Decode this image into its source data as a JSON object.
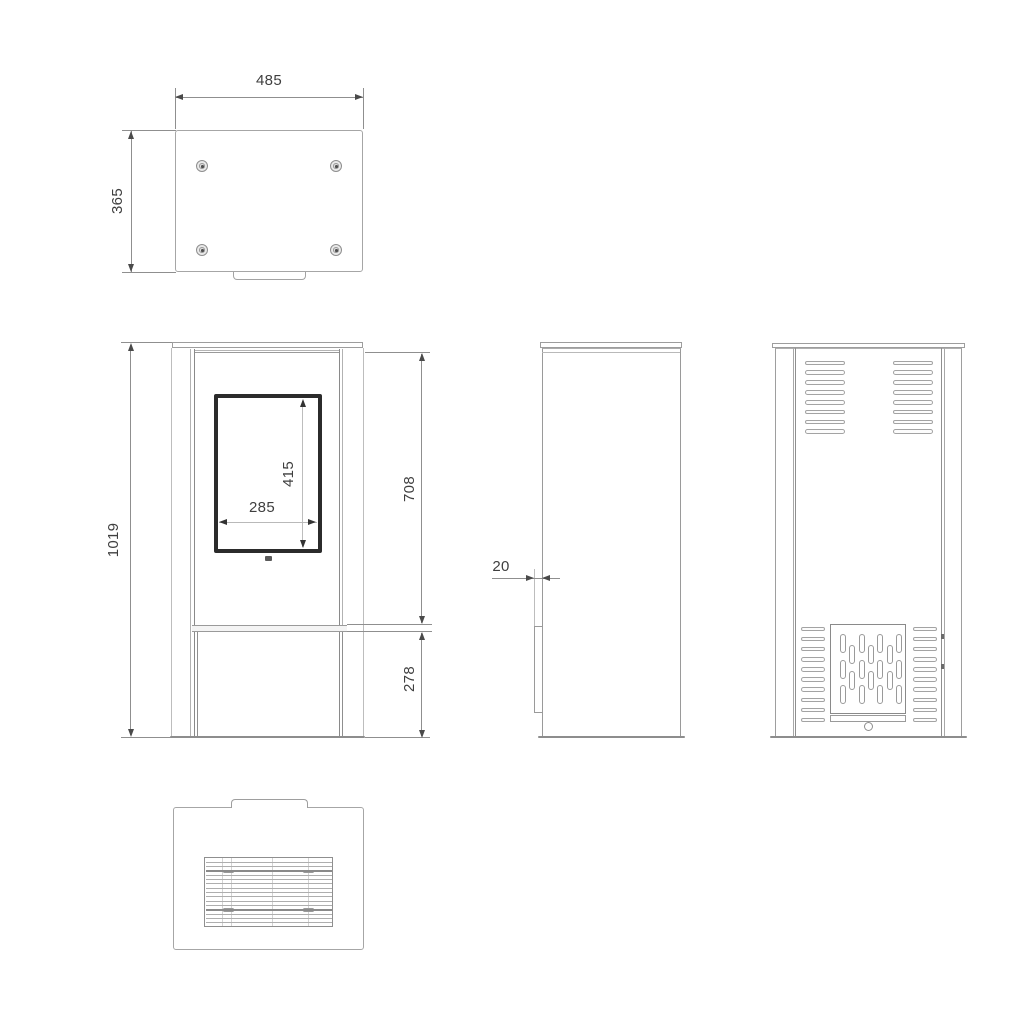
{
  "drawing": {
    "dims": {
      "top_width": "485",
      "top_depth": "365",
      "overall_height": "1019",
      "door_glass_width": "285",
      "door_glass_height": "415",
      "upper_section_height": "708",
      "base_section_height": "278",
      "front_panel_thickness": "20"
    },
    "colors": {
      "object_line": "#a6a6a6",
      "dimension_line": "#8f8f8f",
      "arrow": "#4a4a4a",
      "text": "#3f3f3f",
      "door_frame": "#2b2b2b",
      "background": "#ffffff"
    },
    "counts": {
      "top_screws": 4,
      "back_top_vent_rows": 8,
      "back_top_vent_cols": 2,
      "back_side_vent_rows": 10,
      "back_side_vent_cols": 2,
      "back_center_pills": 18,
      "bottom_grille_lines": 15
    }
  }
}
